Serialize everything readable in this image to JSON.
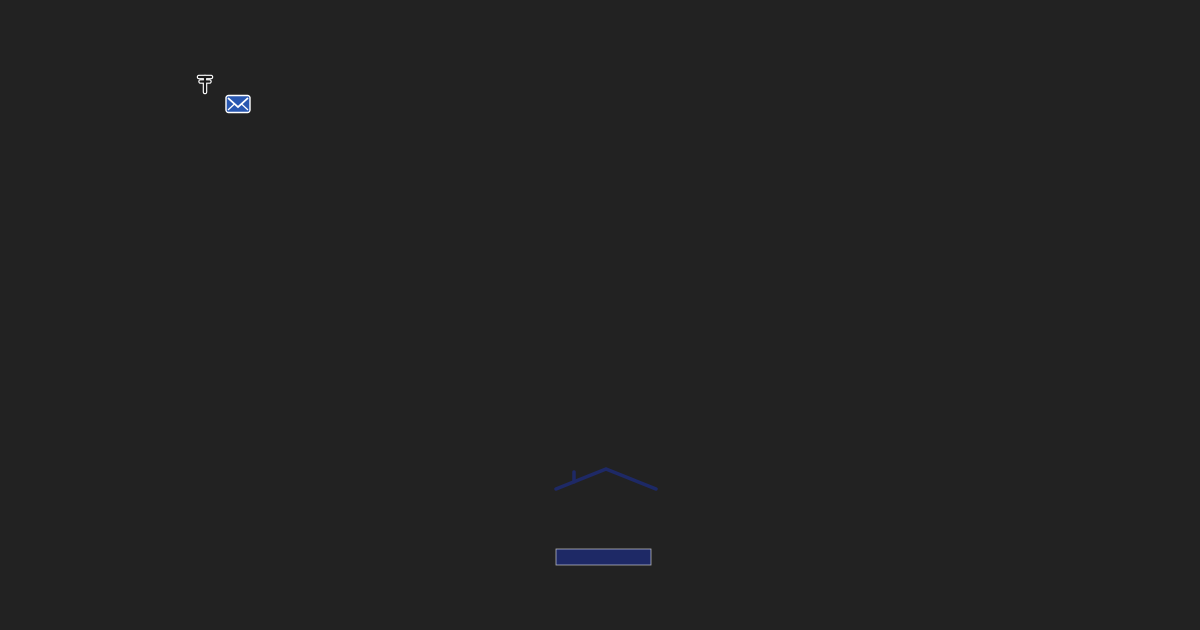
{
  "map": {
    "attribution": "© Seznam.cz, © TopGis",
    "town_label": "u Č. Budějovic",
    "station_label": "Nová Ves - žst.",
    "route_label": "Novohradsko-Doudlebsko",
    "main_road_d": "M237,-6 C224,45 223,74 236,104 C258,152 294,190 332,256 C372,326 398,362 422,422 C446,482 472,545 489,636",
    "secondary_road_d": "M1,385 L122,634",
    "secondary_stripe_d": "M10,381 L131,630",
    "cycle_route_d": "M406,-6 C372,24 332,46 291,62 C262,73 241,78 216,81 C199,97 181,123 161,151 C121,209 61,301 23,373 C15,389 6,406 -3,430",
    "parcel_points": "733,178 690,219 744,316 792,272",
    "bike_icons": [
      [
        208,
        72,
        -10
      ],
      [
        82,
        252,
        -15
      ],
      [
        8,
        368,
        -18
      ]
    ],
    "colors": {
      "road_red": "#d21418",
      "route_magenta": "#e743d2",
      "parcel_red": "#e60000",
      "post_office_blue": "#2857b0"
    }
  },
  "logo": {
    "number": "25",
    "title": "KONTAKT",
    "subtitle": "SERVIS",
    "reality": "REALITY",
    "banner": "Společně již 25 let!",
    "navy": "#1e2a6a",
    "red": "#e30917"
  },
  "scene": {
    "base_fill": "#7e9b55",
    "village": {
      "points": "0,0 668,0 624,630 0,630",
      "fill": "#87a361"
    },
    "fields": [
      {
        "points": "612,0 1200,0 1200,145 1030,205 818,132 688,62",
        "fill": "#a6ba76"
      },
      {
        "points": "620,120 648,60 750,92 700,170",
        "fill": "#8fae62"
      },
      {
        "points": "612,358 648,118 830,136 1036,212 1000,348 800,352",
        "fill": "#7d9d54"
      },
      {
        "points": "468,630 520,382 762,396 1032,472 1200,522 1200,630",
        "fill": "#8aa75e"
      },
      {
        "points": "1018,470 1200,520 1200,630 1058,630",
        "fill": "#9db46b"
      },
      {
        "points": "556,432 590,330 692,362 662,462",
        "fill": "#93af67"
      }
    ],
    "stripes": [
      [
        650,
        330,
        706,
        196
      ],
      [
        680,
        340,
        736,
        206
      ],
      [
        710,
        350,
        766,
        216
      ],
      [
        740,
        356,
        796,
        226
      ],
      [
        770,
        360,
        826,
        236
      ],
      [
        800,
        366,
        856,
        246
      ],
      [
        830,
        32,
        1062,
        96
      ],
      [
        820,
        62,
        1052,
        126
      ],
      [
        560,
        520,
        900,
        560
      ],
      [
        600,
        470,
        950,
        515
      ]
    ],
    "sand": [
      {
        "points": "797,122 872,140 863,216 800,197",
        "fill": "#c9a76e"
      },
      {
        "points": "842,58 884,70 876,112 838,100",
        "fill": "#cfae74"
      }
    ],
    "railway": {
      "points": "0,2 236,10 236,32 0,28",
      "fill": "#a6a6a2",
      "rails": [
        [
          0,
          9,
          236,
          16
        ],
        [
          0,
          21,
          236,
          27
        ]
      ]
    },
    "streets": [
      [
        233,
        97,
        2,
        425,
        11
      ],
      [
        233,
        97,
        406,
        -4,
        10
      ],
      [
        356,
        316,
        560,
        248,
        8
      ],
      [
        420,
        426,
        545,
        388,
        7
      ],
      [
        212,
        632,
        330,
        522,
        8
      ],
      [
        330,
        522,
        470,
        506,
        7
      ],
      [
        458,
        540,
        640,
        600,
        7
      ],
      [
        100,
        46,
        22,
        92,
        8
      ],
      [
        42,
        122,
        0,
        142,
        7
      ],
      [
        62,
        182,
        22,
        300,
        7
      ],
      [
        150,
        58,
        240,
        95,
        8
      ]
    ],
    "parking": {
      "points": "208,42 300,88 262,132 172,84",
      "fill": "#b7b7b1"
    },
    "tracks": [
      [
        905,
        315,
        957,
        416
      ],
      [
        957,
        416,
        1078,
        482
      ],
      [
        1078,
        482,
        1200,
        520
      ]
    ],
    "gray_roads": [
      [
        877,
        456,
        1012,
        587
      ],
      [
        1012,
        587,
        1102,
        632
      ]
    ],
    "house_palette": [
      "#b14a2d",
      "#9a3f27",
      "#c75c32",
      "#70747a",
      "#3e4247",
      "#d8d7d1",
      "#7b5b33",
      "#999da1"
    ],
    "houses": [
      [
        58,
        52,
        30,
        15,
        -12,
        1
      ],
      [
        105,
        42,
        24,
        13,
        -15,
        2
      ],
      [
        150,
        52,
        22,
        12,
        -18,
        6
      ],
      [
        186,
        32,
        20,
        12,
        -20,
        0
      ],
      [
        28,
        96,
        26,
        13,
        -10,
        0
      ],
      [
        86,
        120,
        22,
        12,
        -26,
        4
      ],
      [
        140,
        140,
        26,
        14,
        -25,
        0
      ],
      [
        176,
        156,
        20,
        11,
        -25,
        2
      ],
      [
        60,
        166,
        24,
        12,
        -20,
        1
      ],
      [
        106,
        186,
        22,
        12,
        -22,
        0
      ],
      [
        30,
        206,
        22,
        12,
        -18,
        2
      ],
      [
        76,
        236,
        24,
        13,
        -22,
        0
      ],
      [
        120,
        256,
        22,
        12,
        -24,
        1
      ],
      [
        40,
        280,
        26,
        13,
        -20,
        0
      ],
      [
        92,
        300,
        22,
        12,
        -22,
        2
      ],
      [
        20,
        330,
        22,
        12,
        -20,
        0
      ],
      [
        62,
        350,
        24,
        12,
        -22,
        1
      ],
      [
        112,
        370,
        22,
        12,
        -24,
        0
      ],
      [
        65,
        475,
        46,
        26,
        -18,
        4
      ],
      [
        26,
        472,
        28,
        15,
        -18,
        0
      ],
      [
        20,
        522,
        30,
        16,
        -18,
        5
      ],
      [
        92,
        560,
        26,
        14,
        -18,
        0
      ],
      [
        32,
        592,
        24,
        13,
        -18,
        2
      ],
      [
        152,
        602,
        28,
        15,
        -20,
        1
      ],
      [
        200,
        576,
        24,
        13,
        -20,
        0
      ],
      [
        242,
        542,
        24,
        13,
        -20,
        5
      ],
      [
        282,
        600,
        26,
        14,
        -20,
        2
      ],
      [
        362,
        616,
        24,
        13,
        -20,
        0
      ],
      [
        268,
        56,
        32,
        18,
        -15,
        4
      ],
      [
        322,
        30,
        26,
        14,
        -12,
        1
      ],
      [
        352,
        114,
        148,
        34,
        -17,
        1
      ],
      [
        302,
        172,
        28,
        15,
        -18,
        0
      ],
      [
        262,
        186,
        24,
        13,
        -20,
        2
      ],
      [
        336,
        202,
        26,
        14,
        -18,
        0
      ],
      [
        292,
        226,
        24,
        13,
        -20,
        1
      ],
      [
        252,
        250,
        26,
        14,
        -20,
        0
      ],
      [
        306,
        266,
        24,
        13,
        -22,
        2
      ],
      [
        226,
        290,
        22,
        12,
        -20,
        1
      ],
      [
        272,
        312,
        26,
        14,
        -22,
        0
      ],
      [
        202,
        332,
        24,
        13,
        -22,
        2
      ],
      [
        246,
        362,
        26,
        14,
        -20,
        1
      ],
      [
        302,
        382,
        24,
        13,
        -22,
        0
      ],
      [
        262,
        422,
        26,
        14,
        -20,
        5
      ],
      [
        218,
        456,
        24,
        13,
        -22,
        0
      ],
      [
        282,
        472,
        26,
        14,
        -20,
        1
      ],
      [
        322,
        447,
        22,
        12,
        -20,
        4
      ],
      [
        332,
        520,
        28,
        15,
        -20,
        0
      ],
      [
        376,
        556,
        26,
        14,
        -22,
        2
      ],
      [
        418,
        182,
        30,
        16,
        -16,
        4
      ],
      [
        456,
        146,
        26,
        14,
        -14,
        0
      ],
      [
        500,
        122,
        24,
        13,
        -12,
        1
      ],
      [
        422,
        96,
        26,
        14,
        -15,
        0
      ],
      [
        462,
        252,
        76,
        42,
        -15,
        4
      ],
      [
        432,
        317,
        70,
        40,
        -15,
        4
      ],
      [
        458,
        422,
        26,
        14,
        -18,
        0
      ],
      [
        502,
        456,
        24,
        13,
        -18,
        1
      ],
      [
        432,
        472,
        22,
        12,
        -18,
        2
      ],
      [
        526,
        546,
        26,
        14,
        -18,
        0
      ],
      [
        562,
        586,
        24,
        13,
        -18,
        1
      ],
      [
        548,
        602,
        30,
        16,
        -14,
        0
      ],
      [
        612,
        616,
        28,
        15,
        -14,
        2
      ],
      [
        662,
        596,
        26,
        14,
        -14,
        1
      ],
      [
        920,
        336,
        40,
        22,
        -35,
        4
      ],
      [
        944,
        362,
        28,
        15,
        -35,
        5
      ],
      [
        900,
        426,
        26,
        14,
        -30,
        0
      ],
      [
        936,
        442,
        22,
        12,
        -30,
        2
      ],
      [
        872,
        436,
        20,
        11,
        -30,
        5
      ],
      [
        932,
        522,
        26,
        14,
        -30,
        5
      ],
      [
        1086,
        64,
        88,
        30,
        -35,
        6
      ],
      [
        968,
        602,
        26,
        14,
        -25,
        5
      ],
      [
        1126,
        602,
        26,
        14,
        -20,
        5
      ],
      [
        530,
        38,
        22,
        12,
        -10,
        0
      ],
      [
        562,
        18,
        20,
        11,
        -10,
        2
      ],
      [
        488,
        66,
        22,
        12,
        -12,
        1
      ],
      [
        598,
        46,
        20,
        11,
        -10,
        0
      ]
    ],
    "pools": [
      [
        133,
        403,
        8
      ],
      [
        463,
        240,
        6
      ],
      [
        512,
        300,
        9
      ],
      [
        527,
        120,
        6
      ],
      [
        972,
        546,
        8
      ],
      [
        60,
        447,
        6
      ],
      [
        38,
        246,
        5
      ]
    ],
    "cars": [
      [
        166,
        68,
        -20,
        "#e8e8e8"
      ],
      [
        186,
        76,
        -20,
        "#555b60"
      ],
      [
        206,
        84,
        -20,
        "#8a9096"
      ],
      [
        228,
        92,
        -20,
        "#d8d8d8"
      ],
      [
        252,
        102,
        -20,
        "#3a3f44"
      ],
      [
        172,
        110,
        -20,
        "#c0c4c8"
      ],
      [
        932,
        489,
        40,
        "#f0f0ee"
      ],
      [
        437,
        497,
        -65,
        "#e8e8e6"
      ]
    ],
    "trees": [
      [
        332,
        20,
        16
      ],
      [
        372,
        46,
        13
      ],
      [
        452,
        32,
        12
      ],
      [
        478,
        56,
        10
      ],
      [
        5,
        42,
        13
      ],
      [
        232,
        12,
        11
      ],
      [
        560,
        62,
        15
      ],
      [
        545,
        95,
        12
      ],
      [
        610,
        100,
        12
      ],
      [
        632,
        30,
        22
      ],
      [
        666,
        70,
        18
      ],
      [
        692,
        16,
        16
      ],
      [
        650,
        132,
        13
      ],
      [
        700,
        106,
        11
      ],
      [
        560,
        170,
        13
      ],
      [
        588,
        210,
        11
      ],
      [
        615,
        252,
        10
      ],
      [
        528,
        330,
        11
      ],
      [
        552,
        352,
        9
      ],
      [
        618,
        330,
        9
      ],
      [
        640,
        292,
        9
      ],
      [
        655,
        256,
        9
      ],
      [
        668,
        226,
        8
      ],
      [
        678,
        196,
        8
      ],
      [
        690,
        166,
        8
      ],
      [
        704,
        136,
        8
      ],
      [
        720,
        110,
        9
      ],
      [
        742,
        92,
        10
      ],
      [
        755,
        84,
        8
      ],
      [
        706,
        392,
        14
      ],
      [
        742,
        406,
        11
      ],
      [
        700,
        600,
        13
      ],
      [
        728,
        616,
        10
      ],
      [
        1056,
        444,
        12
      ],
      [
        1080,
        462,
        11
      ],
      [
        1042,
        478,
        9
      ],
      [
        1012,
        30,
        12
      ],
      [
        1035,
        14,
        10
      ],
      [
        598,
        390,
        10
      ],
      [
        640,
        420,
        9
      ],
      [
        560,
        390,
        8
      ],
      [
        505,
        345,
        9
      ],
      [
        475,
        375,
        8
      ],
      [
        880,
        375,
        9
      ],
      [
        855,
        360,
        8
      ],
      [
        830,
        380,
        8
      ],
      [
        905,
        290,
        8
      ],
      [
        860,
        300,
        7
      ],
      [
        985,
        470,
        9
      ],
      [
        952,
        505,
        8
      ],
      [
        148,
        212,
        8
      ],
      [
        96,
        332,
        8
      ],
      [
        170,
        300,
        7
      ],
      [
        140,
        470,
        9
      ],
      [
        180,
        520,
        8
      ],
      [
        120,
        540,
        8
      ]
    ],
    "forest": {
      "points": "1068,0 1200,0 1200,500 1150,440 1100,330 1075,160",
      "fill": "#4e6e3b",
      "blobs": [
        [
          1100,
          60,
          38
        ],
        [
          1140,
          140,
          42
        ],
        [
          1108,
          240,
          38
        ],
        [
          1150,
          320,
          42
        ],
        [
          1102,
          388,
          32
        ],
        [
          1162,
          428,
          36
        ],
        [
          1185,
          200,
          36
        ],
        [
          1180,
          80,
          36
        ],
        [
          1190,
          470,
          30
        ],
        [
          1120,
          20,
          30
        ]
      ]
    },
    "bales": [
      [
        874,
        42
      ],
      [
        881,
        52
      ],
      [
        888,
        63
      ],
      [
        870,
        58
      ]
    ]
  }
}
